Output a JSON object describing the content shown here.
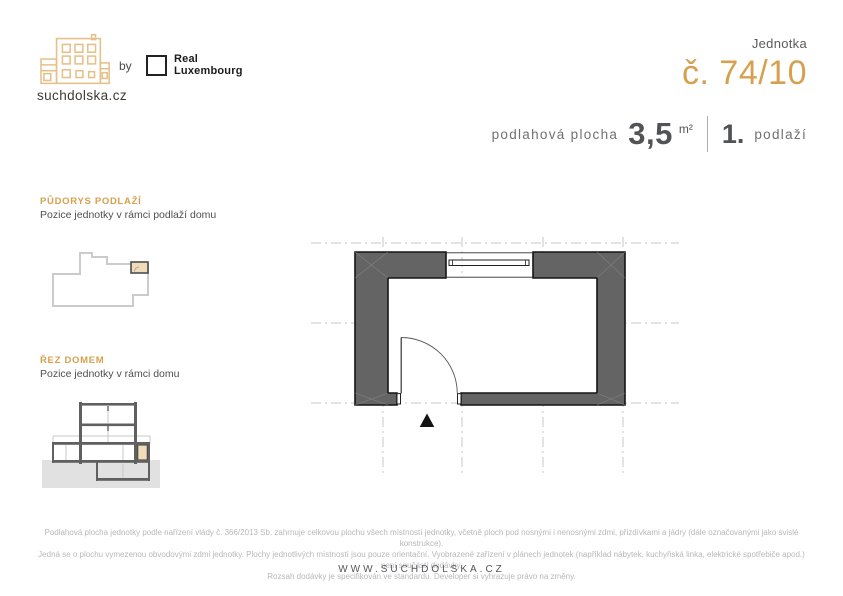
{
  "header": {
    "brand": "suchdolska.cz",
    "by_label": "by",
    "partner_line1": "Real",
    "partner_line2": "Luxembourg",
    "unit_label": "Jednotka",
    "unit_number": "č. 74/10"
  },
  "summary": {
    "area_label": "podlahová plocha",
    "area_value": "3,5",
    "area_unit": "m²",
    "floor_value": "1.",
    "floor_label": "podlaží"
  },
  "sidebar": {
    "floorplan": {
      "title": "PŮDORYS PODLAŽÍ",
      "subtitle": "Pozice jednotky v rámci podlaží domu"
    },
    "section": {
      "title": "ŘEZ DOMEM",
      "subtitle": "Pozice jednotky v rámci domu"
    }
  },
  "footer": {
    "disclaimer_lines": [
      "Podlahová plocha jednotky podle nařízení vlády č. 366/2013 Sb. zahrnuje celkovou plochu všech místností jednotky, včetně ploch pod nosnými i nenosnými zdmi, přizdívkami a jádry (dále označovanými jako svislé konstrukce).",
      "Jedná se o plochu vymezenou obvodovými zdmi jednotky. Plochy jednotlivých místností jsou pouze orientační. Vyobrazené zařízení v plánech jednotek (například nábytek, kuchyňská linka, elektrické spotřebiče apod.) není součástí dodávky.",
      "Rozsah dodávky je specifikován ve standardu. Developer si vyhrazuje právo na změny."
    ],
    "website": "WWW.SUCHDOLSKA.CZ"
  },
  "icons": {
    "brand_logo": "building-outline-icon",
    "partner_logo": "square-frame-icon",
    "entrance_marker": "triangle-up-icon"
  },
  "colors": {
    "accent": "#D7A04E",
    "logo_outline": "#E5C18A",
    "wall_dark": "#646464",
    "unit_highlight": "#F1DCBA",
    "ground": "#E1E1E1",
    "grid": "#C7C7C7",
    "text_dark": "#525356",
    "text_gray": "#6F7072",
    "text_light": "#B7B8BA"
  }
}
